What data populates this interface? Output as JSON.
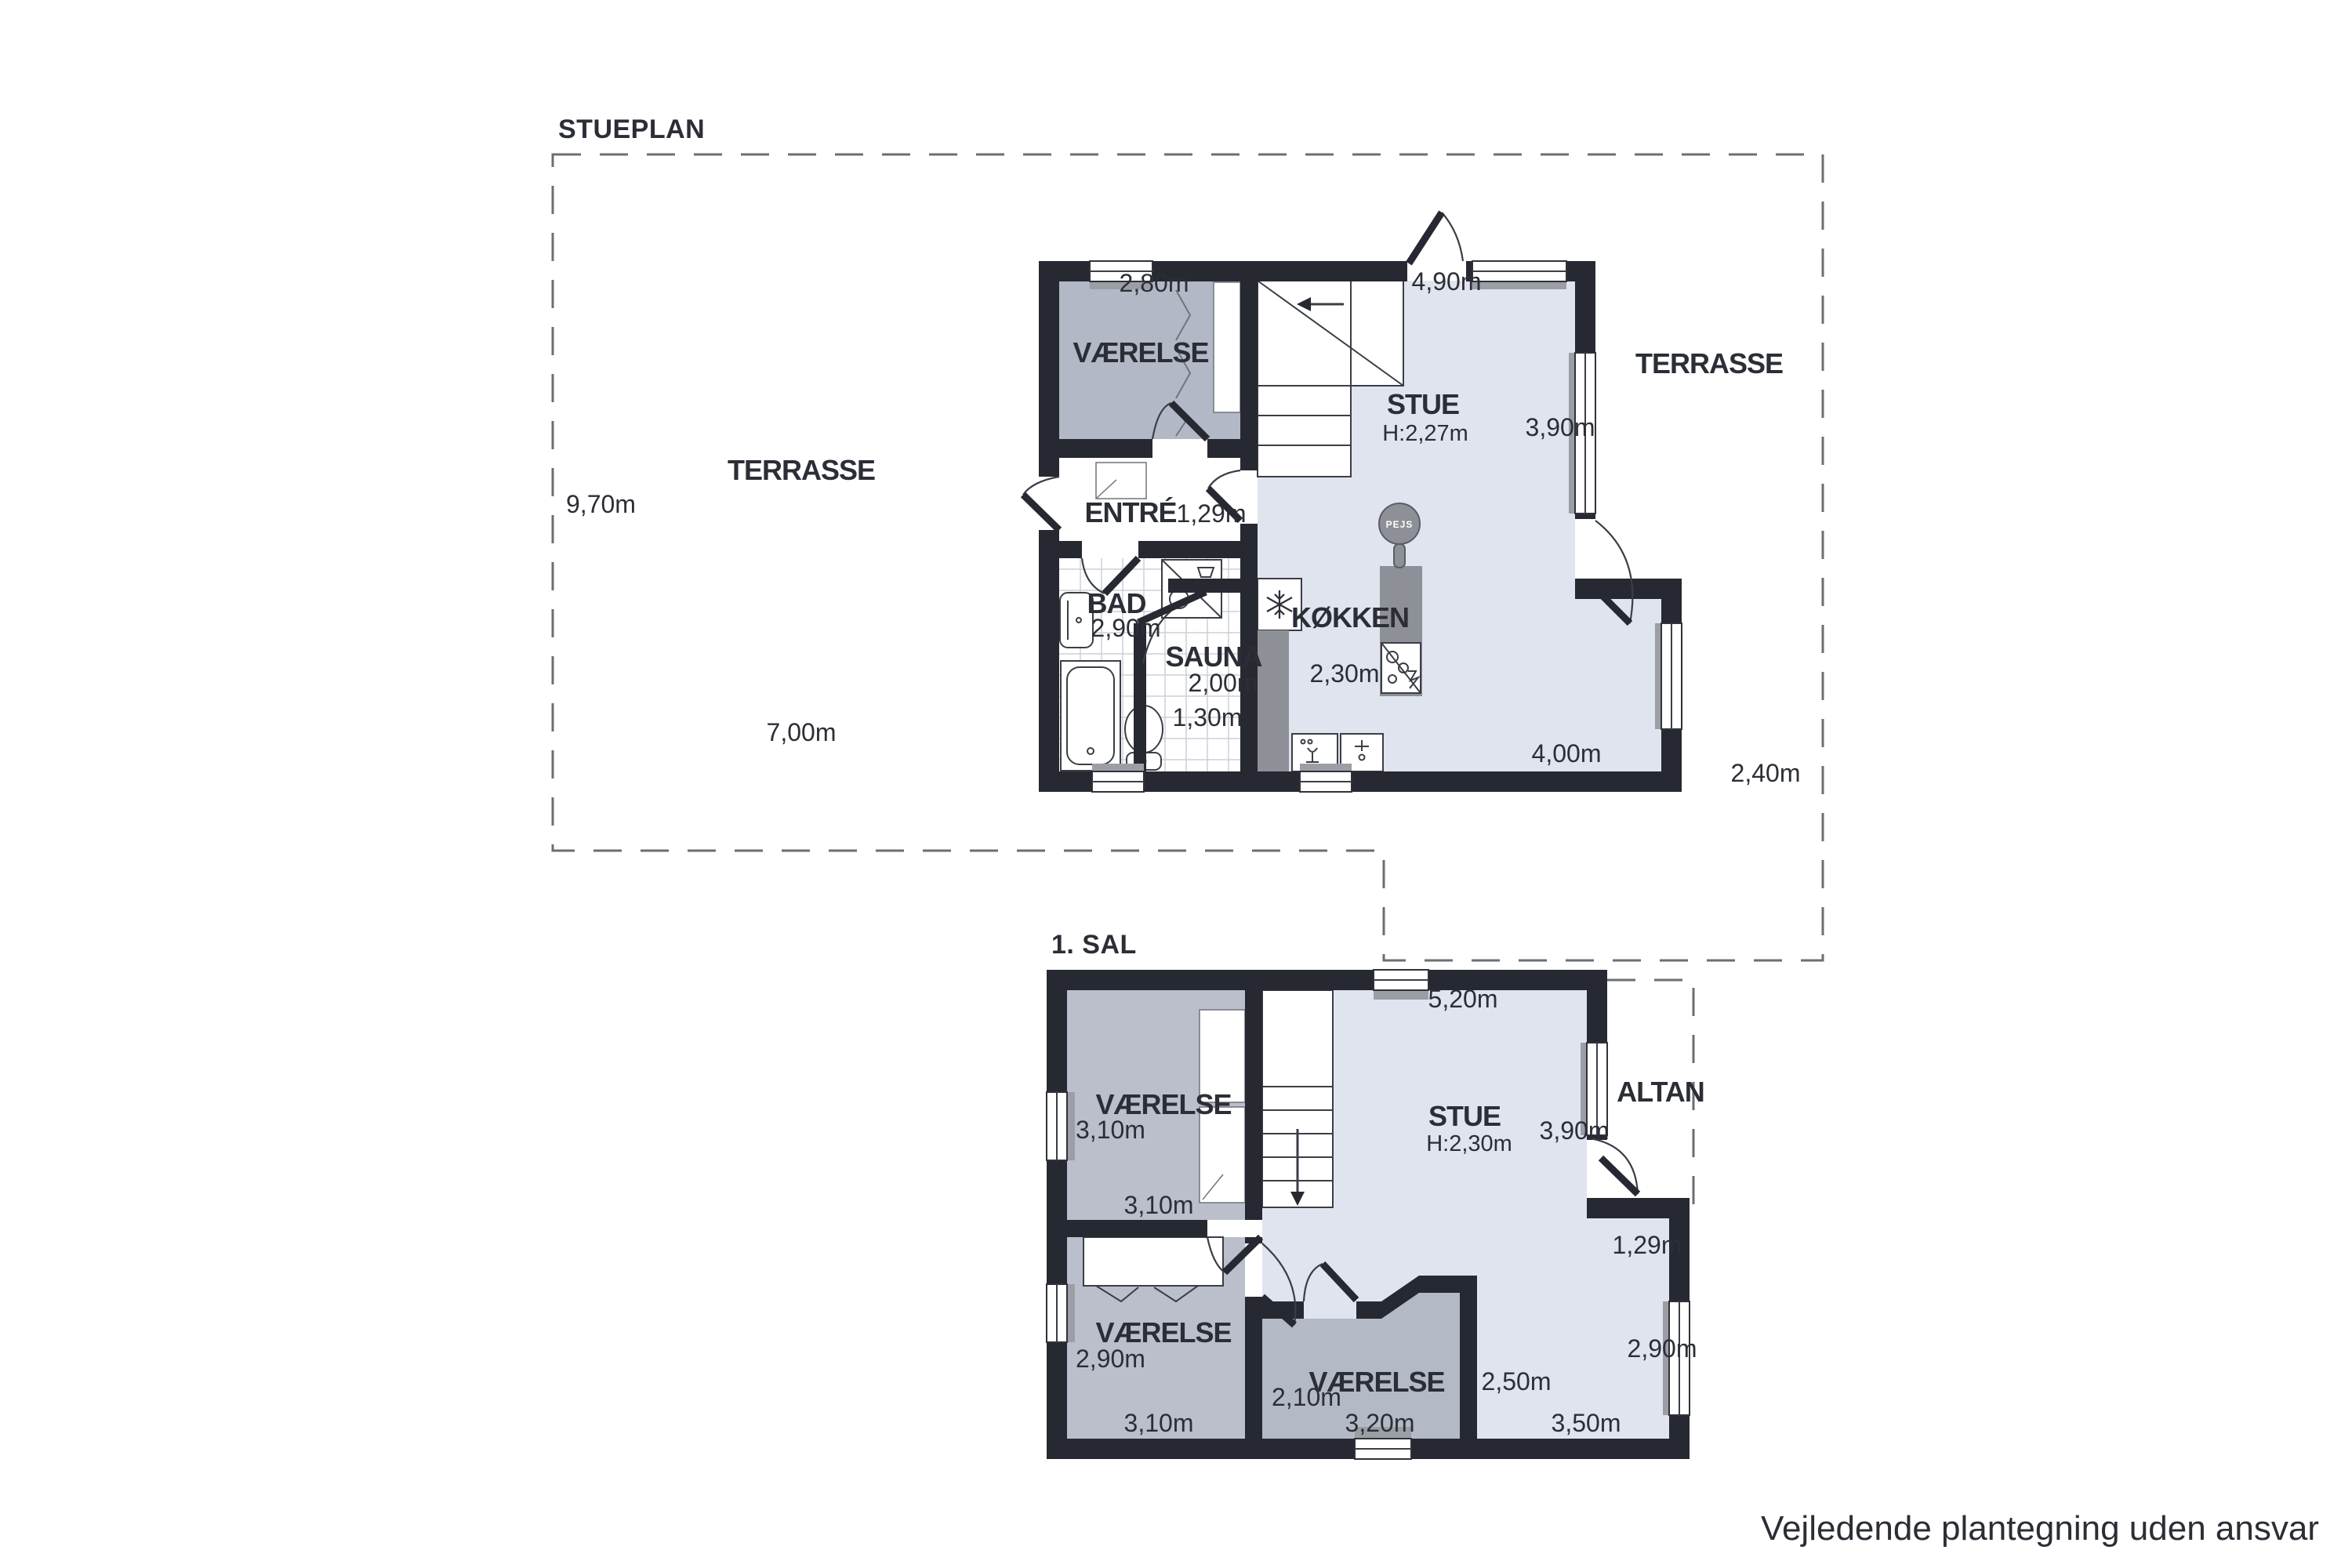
{
  "colors": {
    "wall": "#262931",
    "room_light": "#e0e4ee",
    "room_medium": "#b7bcc8",
    "counter": "#8d9096",
    "text": "#2b2e36"
  },
  "icons": {
    "fridge": "snowflake-icon",
    "fireplace": "round-stove-icon",
    "stair_arrow": "direction-arrow"
  },
  "disclaimer": "Vejledende plantegning uden ansvar",
  "ground_floor": {
    "title": "STUEPLAN",
    "rooms": {
      "vaerelse": "VÆRELSE",
      "entre": "ENTRÉ",
      "bad": "BAD",
      "sauna": "SAUNA",
      "kokken": "KØKKEN",
      "stue": "STUE",
      "stue_height": "H:2,27m"
    },
    "outdoor": {
      "terrasse_left": "TERRASSE",
      "terrasse_right": "TERRASSE"
    },
    "fireplace": "PEJS",
    "dims": {
      "vaerelse_width": "2,80m",
      "stue_top": "4,90m",
      "stue_right": "3,90m",
      "terrasse_height": "9,70m",
      "terrasse_width": "7,00m",
      "entre_width": "1,29m",
      "bad_width": "2,90m",
      "sauna_depth": "2,00m",
      "sauna_width": "1,30m",
      "kokken_width": "2,30m",
      "dining_width": "4,00m",
      "right_offset": "2,40m"
    }
  },
  "first_floor": {
    "title": "1. SAL",
    "rooms": {
      "vaerelse_nw": "VÆRELSE",
      "vaerelse_sw": "VÆRELSE",
      "vaerelse_center": "VÆRELSE",
      "stue": "STUE",
      "stue_height": "H:2,30m",
      "altan": "ALTAN"
    },
    "dims": {
      "stue_top": "5,20m",
      "nw_left": "3,10m",
      "nw_bottom": "3,10m",
      "stue_right": "3,90m",
      "step_width": "1,29m",
      "sw_left": "2,90m",
      "sw_bottom": "3,10m",
      "center_left": "2,10m",
      "center_bottom": "3,20m",
      "center_right": "2,50m",
      "open_right": "2,90m",
      "open_bottom": "3,50m"
    }
  }
}
